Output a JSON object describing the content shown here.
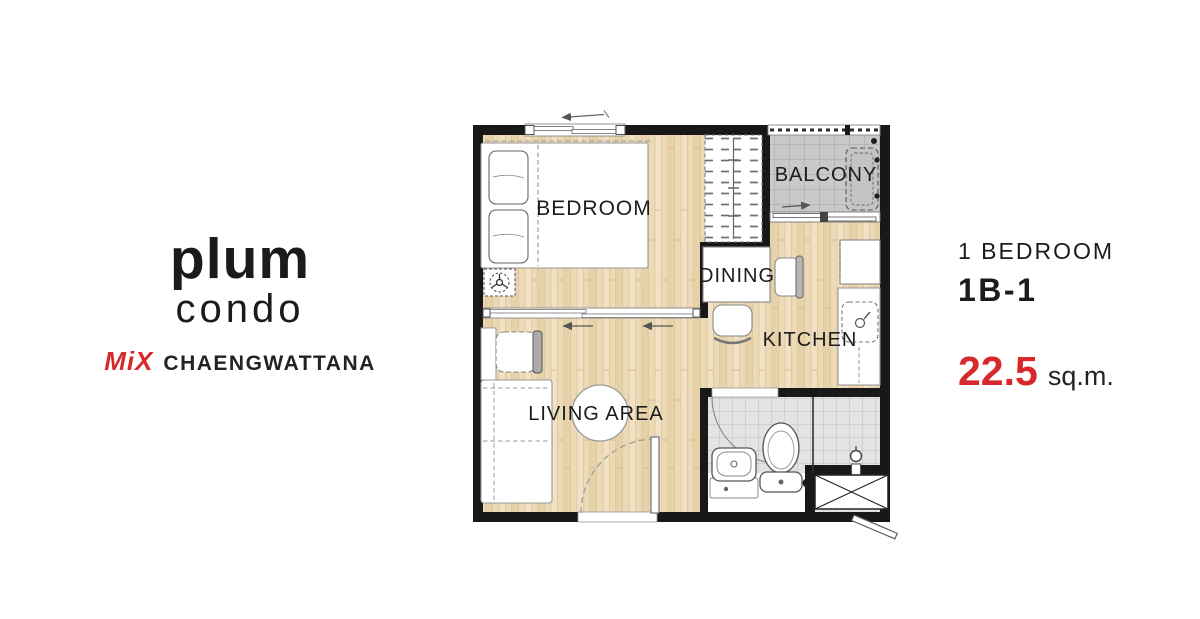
{
  "logo": {
    "brand_line1": "plum",
    "brand_line2": "condo",
    "project": "MiX",
    "location": "CHAENGWATTANA"
  },
  "unit": {
    "type": "1 BEDROOM",
    "code": "1B-1",
    "area_value": "22.5",
    "area_unit": "sq.m."
  },
  "floorplan": {
    "rooms": {
      "bedroom": "BEDROOM",
      "balcony": "BALCONY",
      "dining": "DINING",
      "kitchen": "KITCHEN",
      "living_area": "LIVING AREA"
    }
  },
  "colors": {
    "accent_red": "#d7282c",
    "wall_black": "#181818",
    "wood_floor": "#ecd9b6",
    "balcony_gray": "#c9c9c9",
    "bath_gray": "#e3e3e3"
  }
}
